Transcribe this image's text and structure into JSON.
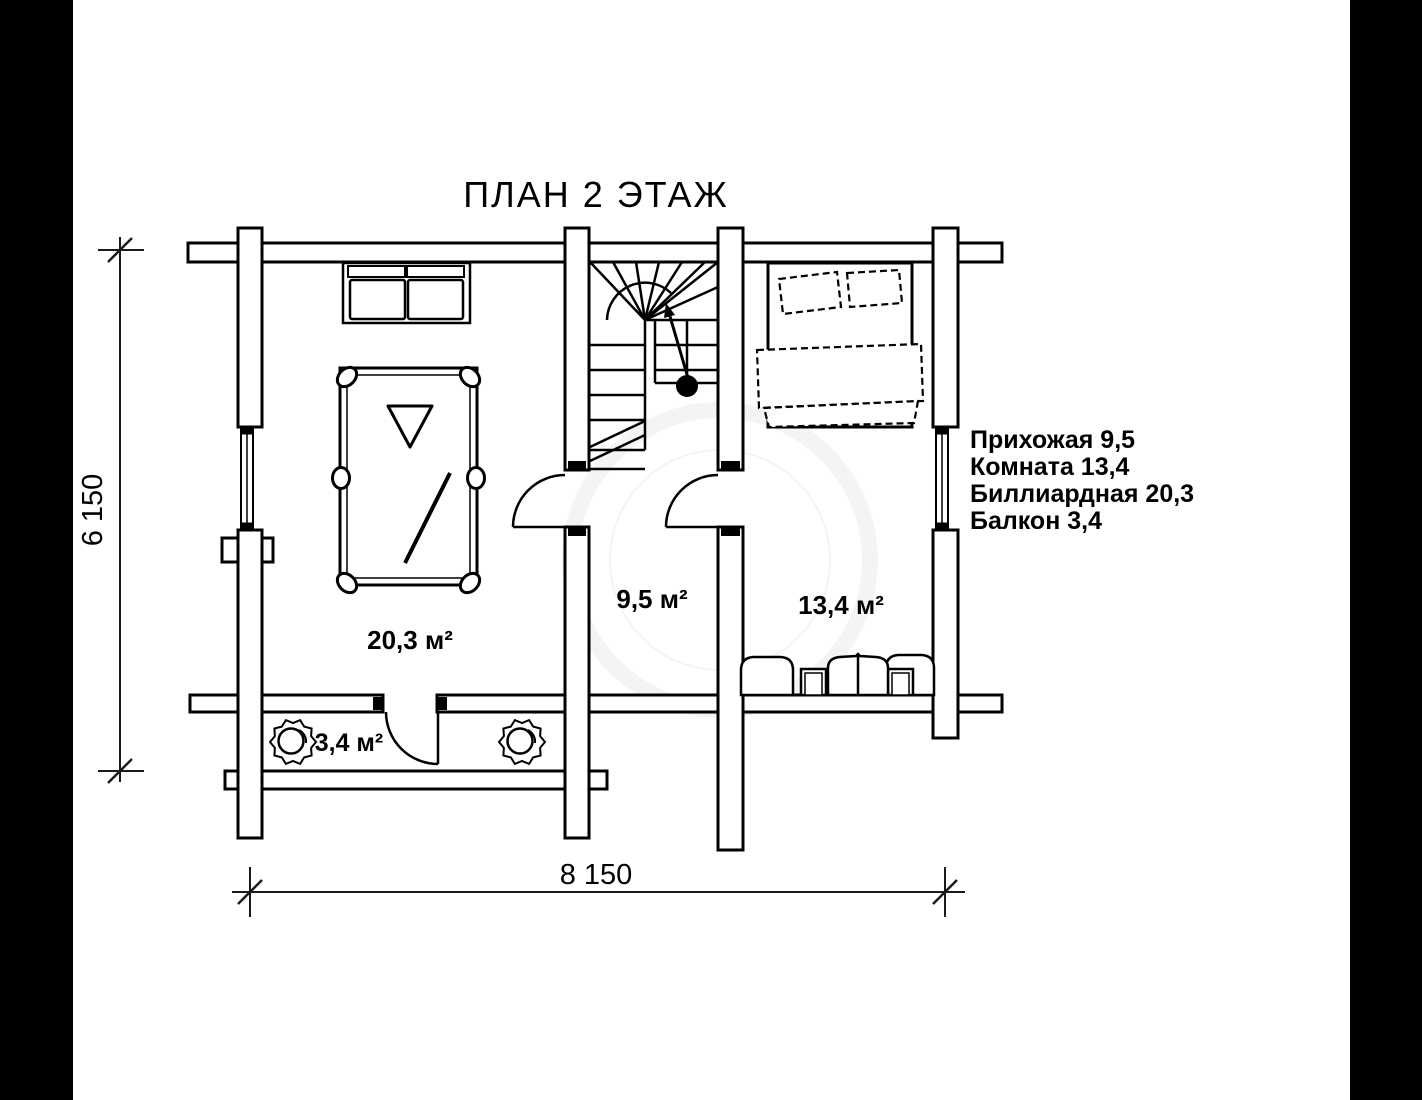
{
  "title": "ПЛАН 2 ЭТАЖ",
  "dimensions": {
    "vertical": "6 150",
    "horizontal": "8 150"
  },
  "rooms": {
    "billiard": {
      "label": "20,3 м²",
      "name": "Биллиардная"
    },
    "hall": {
      "label": "9,5 м²",
      "name": "Прихожая"
    },
    "bedroom": {
      "label": "13,4 м²",
      "name": "Комната"
    },
    "balcony": {
      "label": "3,4 м²",
      "name": "Балкон"
    }
  },
  "legend": {
    "lines": [
      "Прихожая 9,5",
      "Комната 13,4",
      "Биллиардная 20,3",
      "Балкон 3,4"
    ]
  },
  "colors": {
    "background": "#ffffff",
    "lines": "#000000",
    "letterbox": "#000000"
  }
}
